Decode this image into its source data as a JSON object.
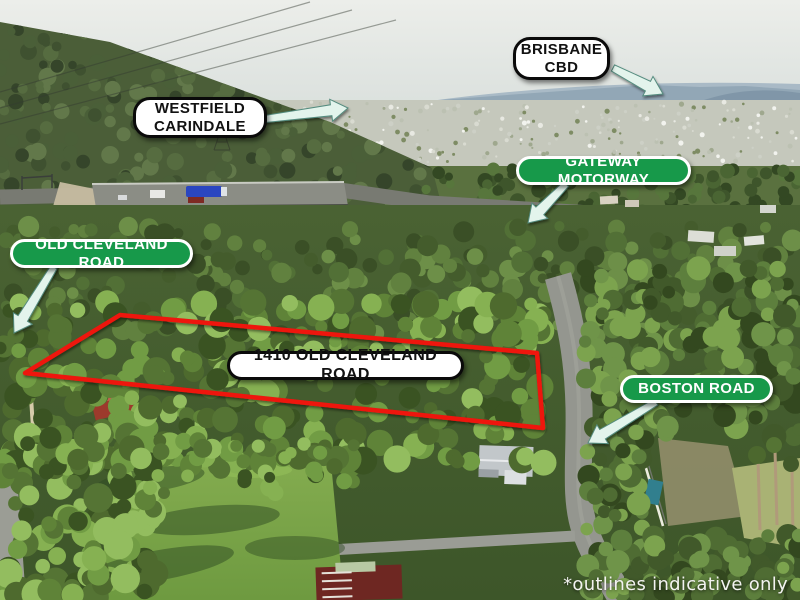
{
  "labels": {
    "brisbane_cbd": {
      "text": "BRISBANE CBD",
      "style": "white-pill-black-border"
    },
    "westfield_carindale": {
      "text": "WESTFIELD CARINDALE",
      "style": "white-pill-black-border"
    },
    "gateway_motorway": {
      "text": "GATEWAY MOTORWAY",
      "style": "green-pill-white-border"
    },
    "old_cleveland_road": {
      "text": "OLD CLEVELAND ROAD",
      "style": "green-pill-white-border"
    },
    "property": {
      "text": "1410 OLD CLEVELAND ROAD",
      "style": "white-pill-black-border"
    },
    "boston_road": {
      "text": "BOSTON ROAD",
      "style": "green-pill-white-border"
    }
  },
  "disclaimer": {
    "text": "*outlines indicative only"
  },
  "icons": {
    "arrow_brisbane_cbd": "pointer-arrow",
    "arrow_westfield": "pointer-arrow",
    "arrow_gateway": "pointer-arrow",
    "arrow_old_cleveland": "pointer-arrow",
    "arrow_boston": "pointer-arrow"
  },
  "colors": {
    "property_outline_red": "#ee1310",
    "label_green": "#17994a",
    "label_white_bg": "#ffffff",
    "label_border_black": "#0a0a0a",
    "label_text_black": "#121212",
    "label_text_white": "#ffffff",
    "arrow_fill": "#e3f4ec",
    "arrow_stroke": "#558c7f"
  }
}
